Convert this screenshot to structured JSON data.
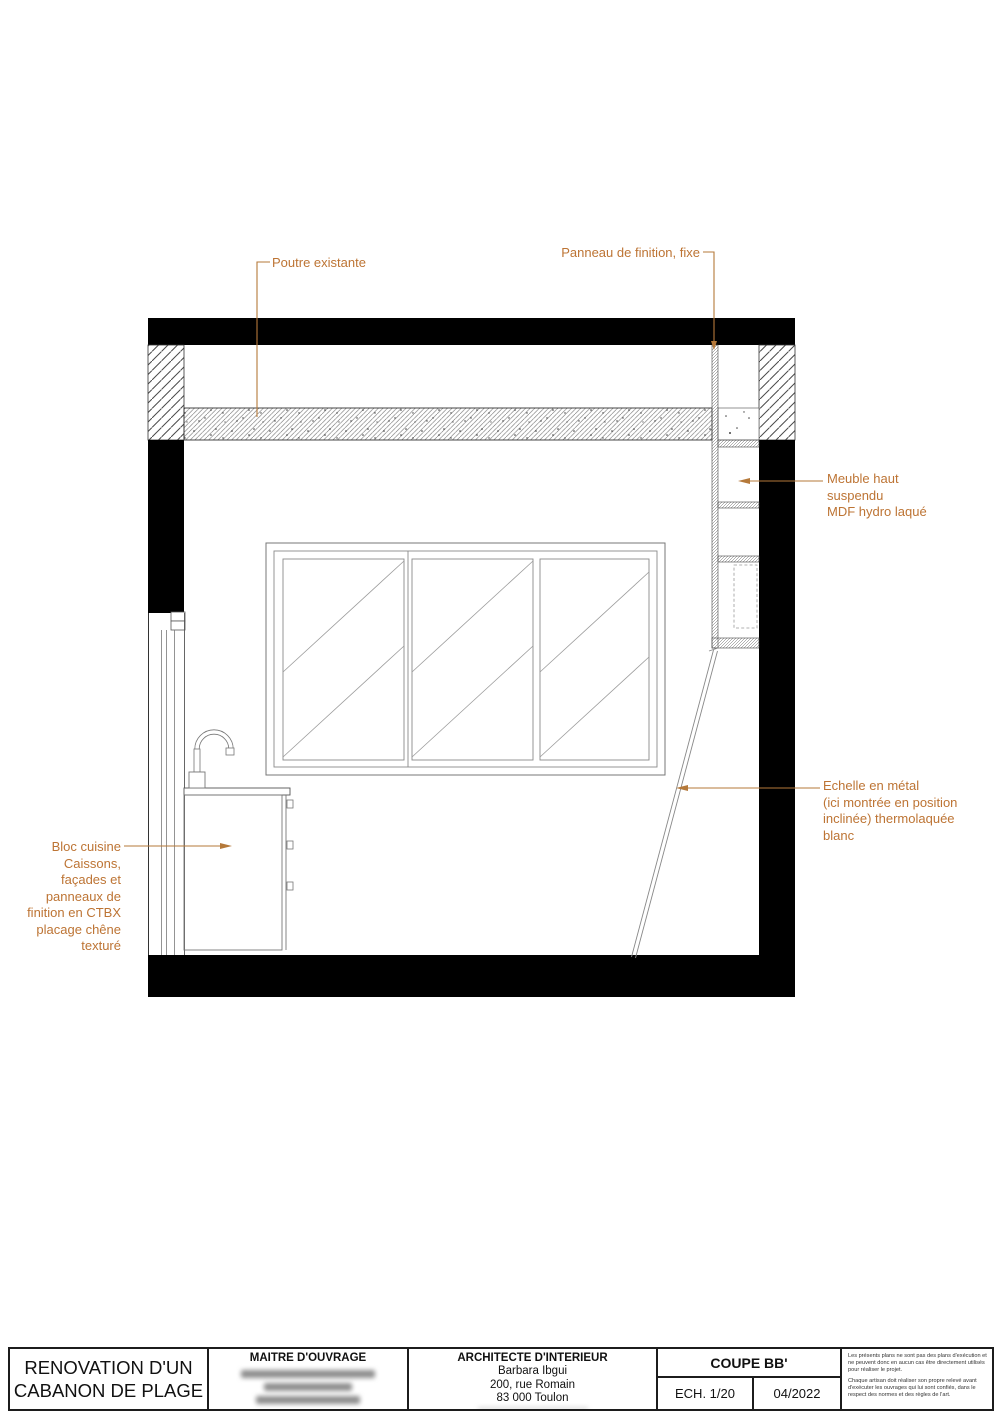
{
  "annotations": {
    "beam": {
      "label": "Poutre existante"
    },
    "panel": {
      "label": "Panneau de finition, fixe"
    },
    "cabinet": {
      "line1": "Meuble haut",
      "line2": "suspendu",
      "line3": "MDF hydro laqué"
    },
    "ladder": {
      "line1": "Echelle en métal",
      "line2": "(ici montrée en position",
      "line3": "inclinée) thermolaquée",
      "line4": "blanc"
    },
    "kitchen": {
      "line1": "Bloc cuisine",
      "line2": "Caissons,",
      "line3": "façades et",
      "line4": "panneaux de",
      "line5": "finition en CTBX",
      "line6": "placage chêne",
      "line7": "texturé"
    }
  },
  "title_block": {
    "project_title_line1": "RENOVATION D'UN",
    "project_title_line2": "CABANON DE PLAGE",
    "client_header": "MAITRE D'OUVRAGE",
    "architect_header": "ARCHITECTE D'INTERIEUR",
    "architect_name": "Barbara Ibgui",
    "architect_address_line1": "200, rue Romain",
    "architect_address_line2": "83 000 Toulon",
    "drawing_title": "COUPE BB'",
    "scale": "ECH. 1/20",
    "date": "04/2022",
    "disclaimer_para1": "Les présents plans ne sont pas des plans d'exécution et ne peuvent donc en aucun cas être directement utilisés pour réaliser le projet.",
    "disclaimer_para2": "Chaque artisan doit réaliser son propre relevé avant d'exécuter les ouvrages qui lui sont confiés, dans le respect des normes et des règles de l'art."
  },
  "colors": {
    "annotation_orange": "#bd7434",
    "leader_orange": "#b5793a",
    "wall_black": "#000000"
  }
}
